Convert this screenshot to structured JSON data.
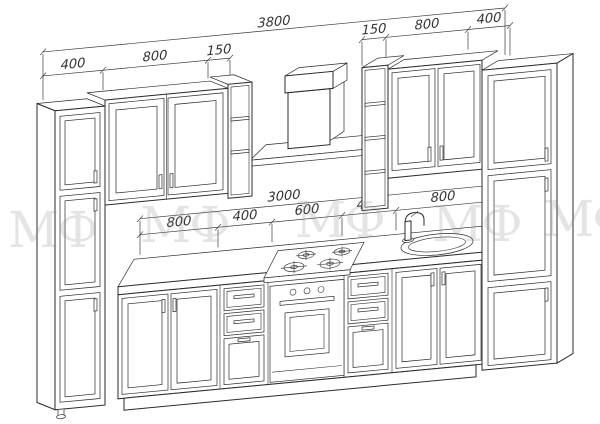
{
  "drawing": {
    "background": "#ffffff",
    "line_color": "#2b2b2b",
    "dim_color": "#3a3a3a",
    "watermark": {
      "text": "МФ",
      "color": "#8a8a8a"
    },
    "dims": {
      "total_top": "3800",
      "upper_left": [
        "400",
        "800",
        "150"
      ],
      "upper_right": [
        "150",
        "800",
        "400"
      ],
      "base_total": "3000",
      "base_row": [
        "800",
        "400",
        "600",
        "400",
        "800"
      ]
    }
  }
}
